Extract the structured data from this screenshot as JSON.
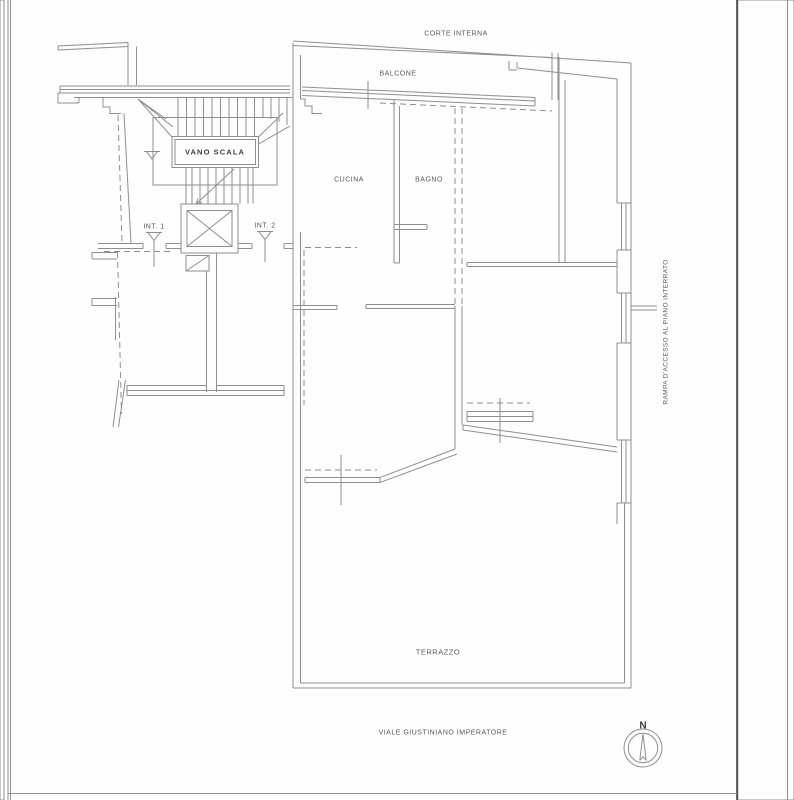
{
  "document": {
    "type": "floor-plan-scan",
    "language": "it"
  },
  "plan": {
    "labels": {
      "corte_interna": "CORTE INTERNA",
      "balcone": "BALCONE",
      "cucina": "CUCINA",
      "bagno": "BAGNO",
      "vano_scala": "VANO SCALA",
      "int1": "INT. 1",
      "int2": "INT. 2",
      "terrazzo": "TERRAZZO"
    },
    "streets": {
      "right_vertical": "RAMPA D'ACCESSO AL PIANO INTERRATO",
      "bottom": "VIALE GIUSTINIANO IMPERATORE"
    },
    "compass": {
      "label": "N"
    },
    "colors": {
      "plan_line": "#8f8f8f",
      "label_text": "#5a5a5a",
      "page_edge_line": "#4b4b4b",
      "margin_gray": "#dcdcdc",
      "background": "#fefefe"
    }
  }
}
